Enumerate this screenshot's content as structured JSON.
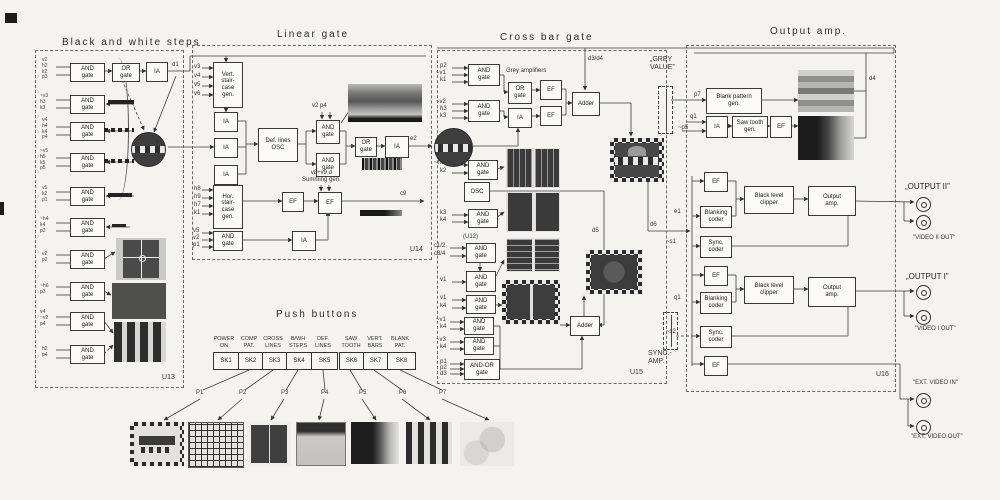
{
  "titles": {
    "bw": "Black and white steps",
    "linear": "Linear gate",
    "cross": "Cross bar gate",
    "output": "Output amp.",
    "push": "Push buttons"
  },
  "units": {
    "u12": "(U12)",
    "u13": "U13",
    "u14": "U14",
    "u15": "U15",
    "u16": "U16"
  },
  "blocks": {
    "and": "AND\ngate",
    "or": "OR\ngate",
    "ia": "IA",
    "ef": "EF",
    "adder": "Adder",
    "osc": "OSC",
    "andor": "AND-OR\ngate",
    "vert_stair": "Vert.\nstair-\ncase\ngen.",
    "hor_stair": "Hor.\nstair-\ncase\ngen.",
    "def_osc": "Def. lines\nOSC",
    "grey_amps": "Grey amplifiers",
    "summing": "v8+v9  d\nSumming gen.",
    "blank_gen": "Blank pattern\ngen.",
    "saw_gen": "Saw tooth\ngen.",
    "blank_coder": "Blanking\ncoder",
    "sync_coder": "Sync.\ncoder",
    "black_clip": "Black level\nclipper",
    "out_amp": "Output\namp."
  },
  "pots": {
    "grey_value": "„GREY\nVALUE”",
    "sync_amp": "SYNC.-\nAMP."
  },
  "signals": {
    "d1": "d1",
    "e1": "e1",
    "e2": "e2",
    "c9": "c9",
    "v1": "v1",
    "v2p4": "v2  p4",
    "v3": "v3",
    "v4": "v4",
    "v5": "v5",
    "v6": "v6",
    "h3": "h3",
    "h7": "h7",
    "h8": "h8",
    "h9": "h9",
    "k1": "k1",
    "k2": "k2",
    "k3": "k3",
    "k4": "k4",
    "p1": "p1",
    "p2": "p2",
    "p7": "p7",
    "q1": "q1",
    "d3": "d3",
    "d34": "d3/d4",
    "d4": "d4",
    "d5": "d5",
    "d6": "d6",
    "np5": "~p5",
    "ns1": "~s1",
    "ns2": "~s2",
    "nv1": "~v1",
    "nv2": "~v2",
    "nv3": "~v3",
    "nh6": "~h6",
    "c12": "c1/2",
    "c34": "c3/4",
    "lg_and_in": "v5\nv2\np1"
  },
  "bw_inputs": [
    "v2\nh2\nk2\np3",
    "~v3\nh3\nk3",
    "v4\nh4\nk4\np4",
    "~v5\nh5\nk5\np5",
    "v5\nk2\np1",
    "~h4\nk4\np2",
    "v2\np2",
    "~h6\np3",
    "v4\n~v2\np4",
    "h2\np4"
  ],
  "push": {
    "buttons": [
      {
        "id": "SK1",
        "label": "POWER\nON"
      },
      {
        "id": "SK2",
        "label": "COMP\nPAT."
      },
      {
        "id": "SK3",
        "label": "CROSS\nLINES"
      },
      {
        "id": "SK4",
        "label": "B/WH\nSTEPS"
      },
      {
        "id": "SK5",
        "label": "DEF.\nLINES"
      },
      {
        "id": "SK6",
        "label": "SAW\nTOOTH"
      },
      {
        "id": "SK7",
        "label": "VERT.\nBARS"
      },
      {
        "id": "SK8",
        "label": "BLANK\nPAT."
      }
    ],
    "p_labels": [
      "P1",
      "P2",
      "P3",
      "P4",
      "P5",
      "P6",
      "P7"
    ]
  },
  "outputs": {
    "out2": "„OUTPUT II”",
    "video2": "\"VIDEO II OUT\"",
    "out1": "„OUTPUT I”",
    "video1": "\"VIDEO I OUT\"",
    "ext_in": "\"EXT. VIDEO IN\"",
    "ext_out": "\"EXT. VIDEO OUT\""
  }
}
